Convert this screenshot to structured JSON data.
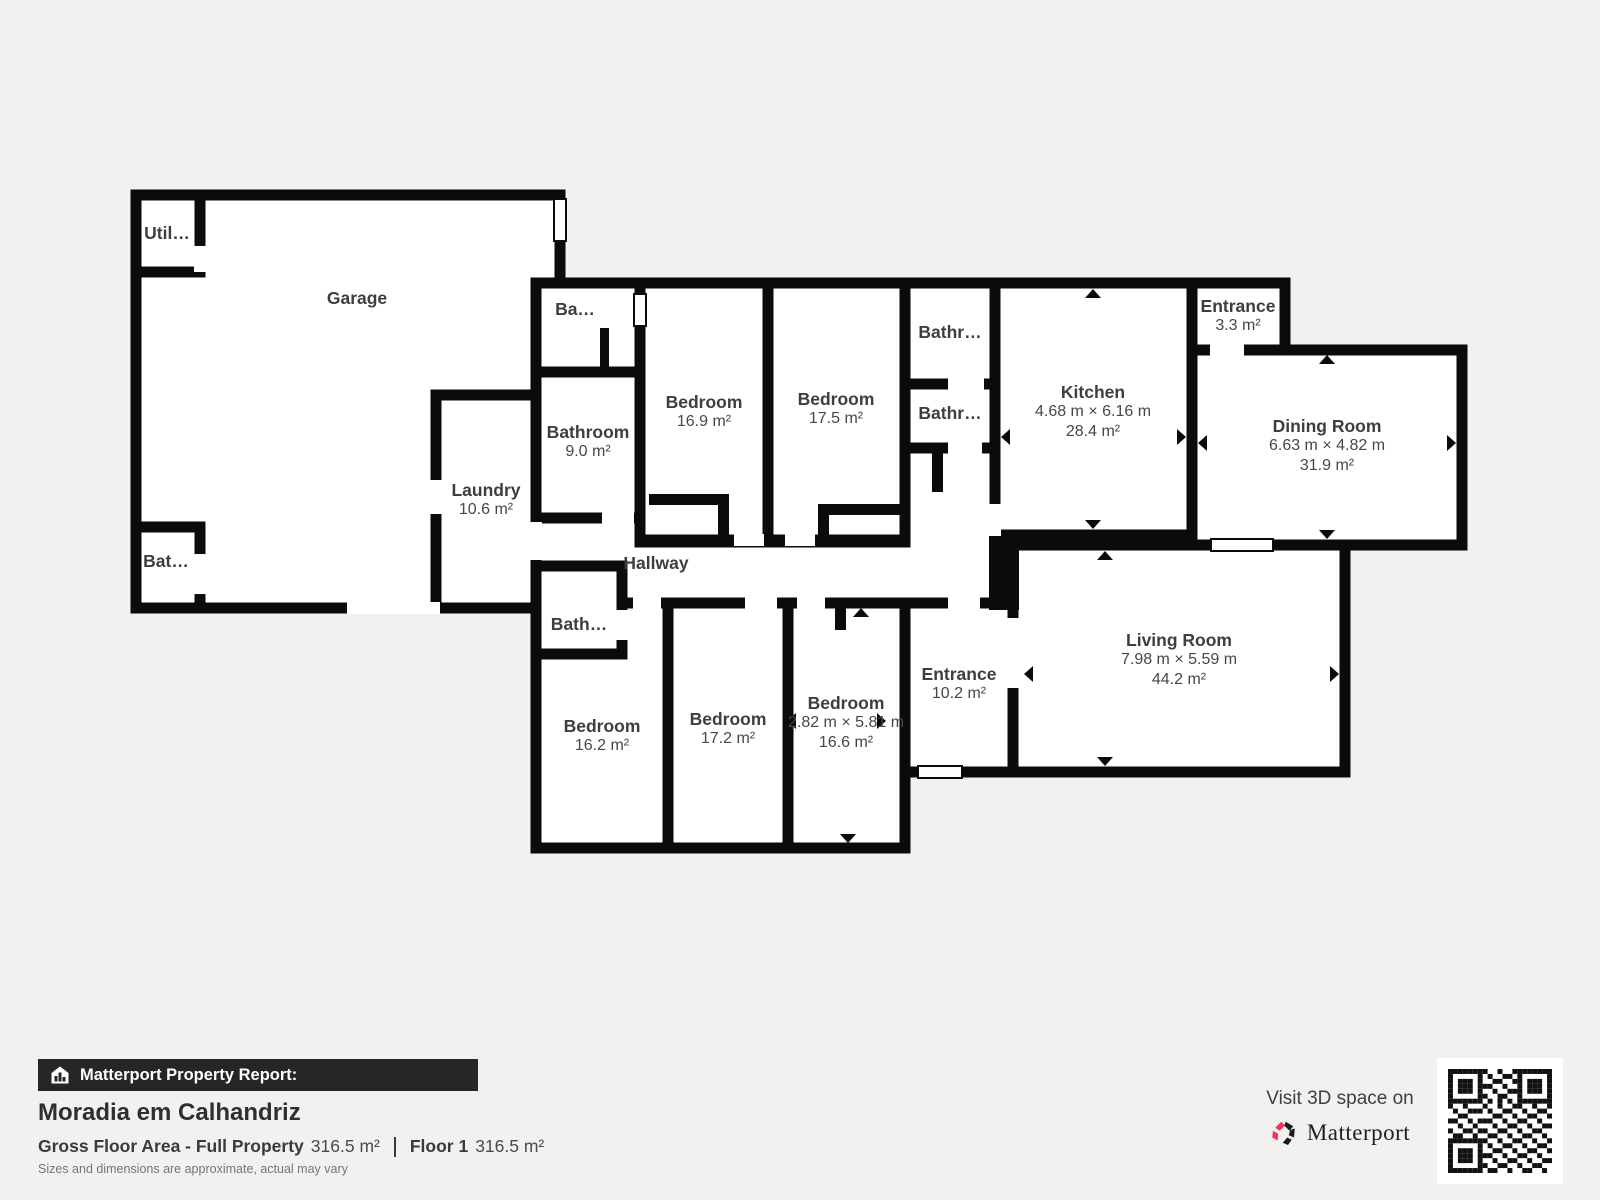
{
  "floorplan": {
    "rooms": [
      {
        "id": "utility",
        "name": "Util…"
      },
      {
        "id": "garage",
        "name": "Garage"
      },
      {
        "id": "bathroom-garage",
        "name": "Bat…"
      },
      {
        "id": "laundry",
        "name": "Laundry",
        "area": "10.6 m²"
      },
      {
        "id": "bathroom-small-top",
        "name": "Ba…"
      },
      {
        "id": "bathroom-9",
        "name": "Bathroom",
        "area": "9.0 m²"
      },
      {
        "id": "bedroom-169",
        "name": "Bedroom",
        "area": "16.9 m²"
      },
      {
        "id": "bedroom-175",
        "name": "Bedroom",
        "area": "17.5 m²"
      },
      {
        "id": "bathroom-a",
        "name": "Bathr…"
      },
      {
        "id": "bathroom-b",
        "name": "Bathr…"
      },
      {
        "id": "kitchen",
        "name": "Kitchen",
        "dims": "4.68 m × 6.16 m",
        "area": "28.4 m²"
      },
      {
        "id": "entrance-33",
        "name": "Entrance",
        "area": "3.3 m²"
      },
      {
        "id": "dining-room",
        "name": "Dining Room",
        "dims": "6.63 m × 4.82 m",
        "area": "31.9 m²"
      },
      {
        "id": "hallway",
        "name": "Hallway"
      },
      {
        "id": "bathroom-small-bottom",
        "name": "Bath…"
      },
      {
        "id": "bedroom-162",
        "name": "Bedroom",
        "area": "16.2 m²"
      },
      {
        "id": "bedroom-172",
        "name": "Bedroom",
        "area": "17.2 m²"
      },
      {
        "id": "bedroom-166",
        "name": "Bedroom",
        "dims": "2.82 m × 5.81 m",
        "area": "16.6 m²"
      },
      {
        "id": "entrance-102",
        "name": "Entrance",
        "area": "10.2 m²"
      },
      {
        "id": "living-room",
        "name": "Living Room",
        "dims": "7.98 m × 5.59 m",
        "area": "44.2 m²"
      }
    ]
  },
  "footer": {
    "report_label": "Matterport Property Report:",
    "title": "Moradia em Calhandriz",
    "gfa_label": "Gross Floor Area - Full Property",
    "gfa_value": "316.5 m²",
    "floor_label": "Floor 1",
    "floor_value": "316.5 m²",
    "disclaimer": "Sizes and dimensions are approximate, actual may vary"
  },
  "cta": {
    "text": "Visit 3D space on",
    "brand": "Matterport"
  },
  "icons": {
    "report_bar": "house-chart-icon",
    "brand": "matterport-burst-icon",
    "qr": "qr-code"
  },
  "colors": {
    "wall": "#0b0b0b",
    "background": "#f2f1ef",
    "room_fill": "#ffffff",
    "label_text": "#3e3e3e",
    "bar_bg": "#262626",
    "bar_text": "#ffffff",
    "brand_pink": "#f5325b"
  }
}
